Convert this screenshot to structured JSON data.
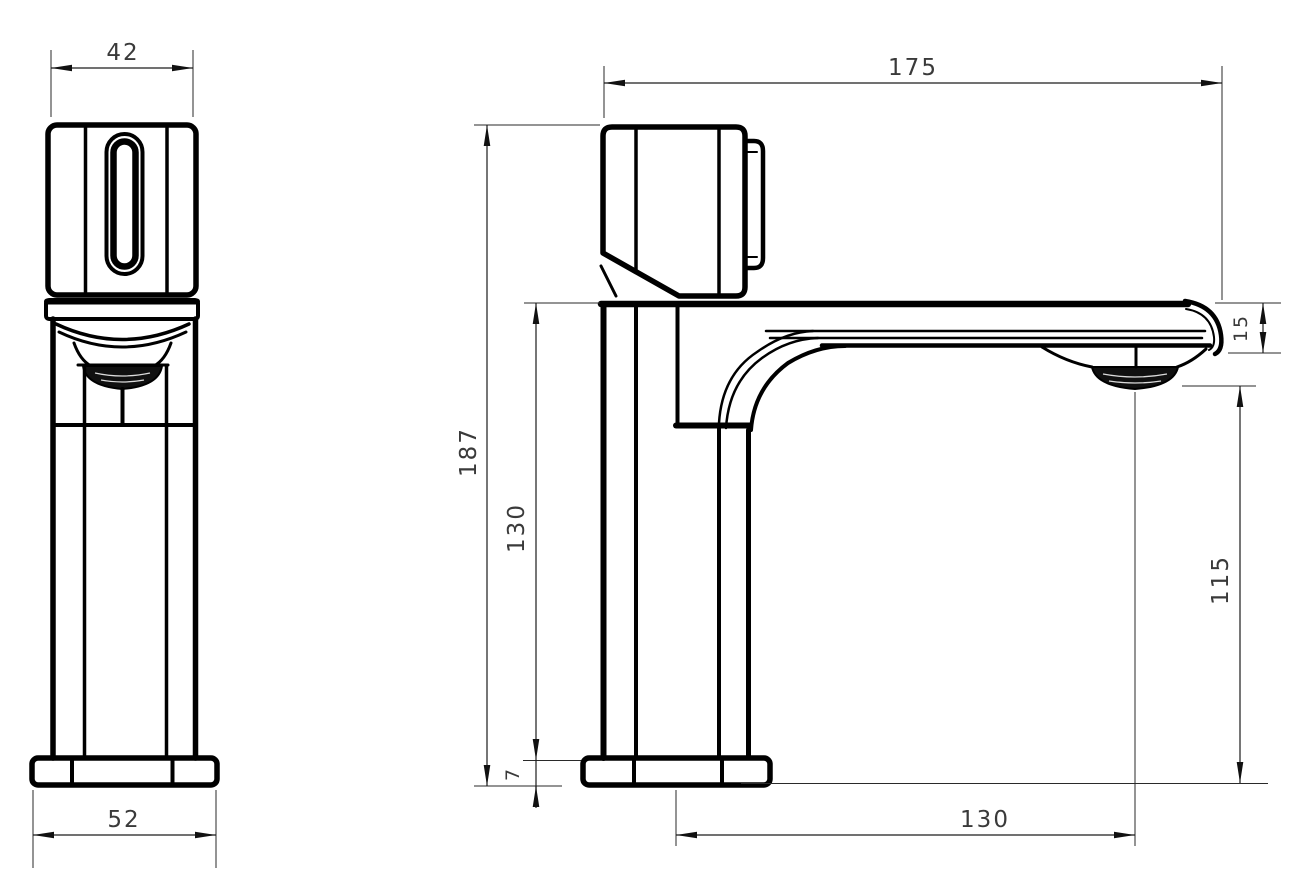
{
  "drawing": {
    "type": "technical-drawing",
    "subject": "basin faucet two-view dimensioned drawing",
    "colors": {
      "line": "#000000",
      "dimension_text": "#3a3a3a",
      "background": "#ffffff"
    },
    "front_view": {
      "dims": {
        "handle_width": "42",
        "base_width": "52"
      }
    },
    "side_view": {
      "dims": {
        "overall_length": "175",
        "overall_height": "187",
        "spout_height": "130",
        "base_thickness": "7",
        "spout_tip_depth": "15",
        "outlet_clearance": "115",
        "spout_reach": "130"
      }
    }
  }
}
